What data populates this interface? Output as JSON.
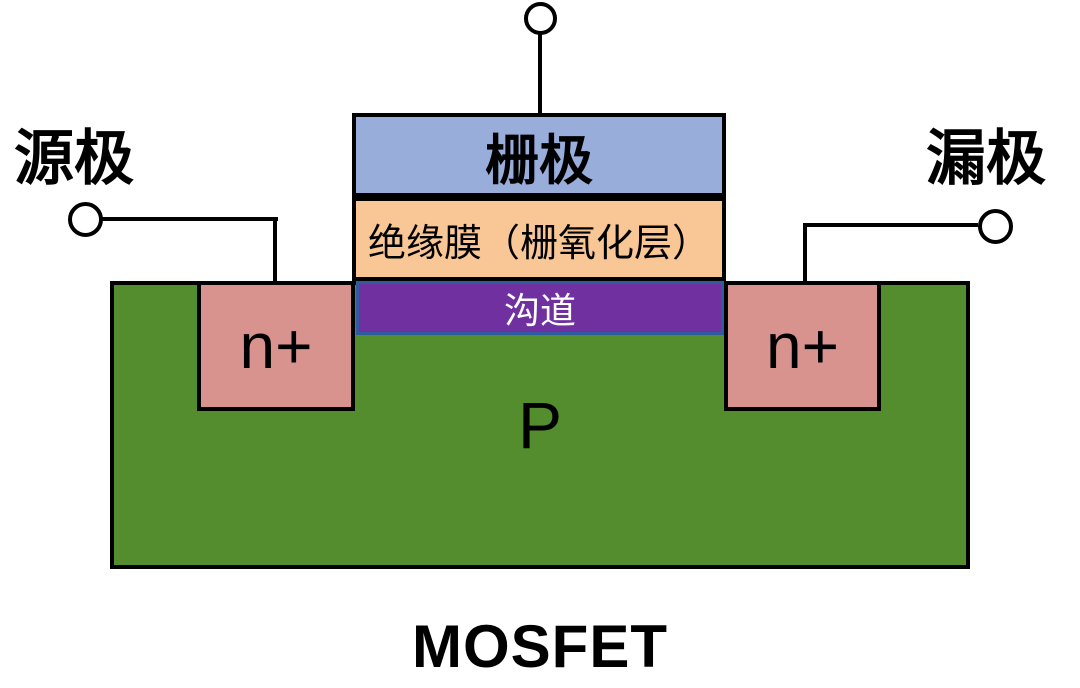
{
  "diagram": {
    "title": "MOSFET",
    "gate": {
      "label": "栅极"
    },
    "insulator": {
      "label": "绝缘膜（栅氧化层）"
    },
    "channel": {
      "label": "沟道"
    },
    "source": {
      "label": "源极",
      "region_label": "n+"
    },
    "drain": {
      "label": "漏极",
      "region_label": "n+"
    },
    "substrate": {
      "label": "P"
    }
  },
  "colors": {
    "gate_fill": "#99ADDB",
    "insulator_fill": "#F8C795",
    "channel_fill": "#7030A0",
    "channel_border": "#2E5C9E",
    "region_fill": "#D9938F",
    "substrate_fill": "#538D2E",
    "outline": "#000000",
    "channel_text": "#FFFFFF"
  }
}
